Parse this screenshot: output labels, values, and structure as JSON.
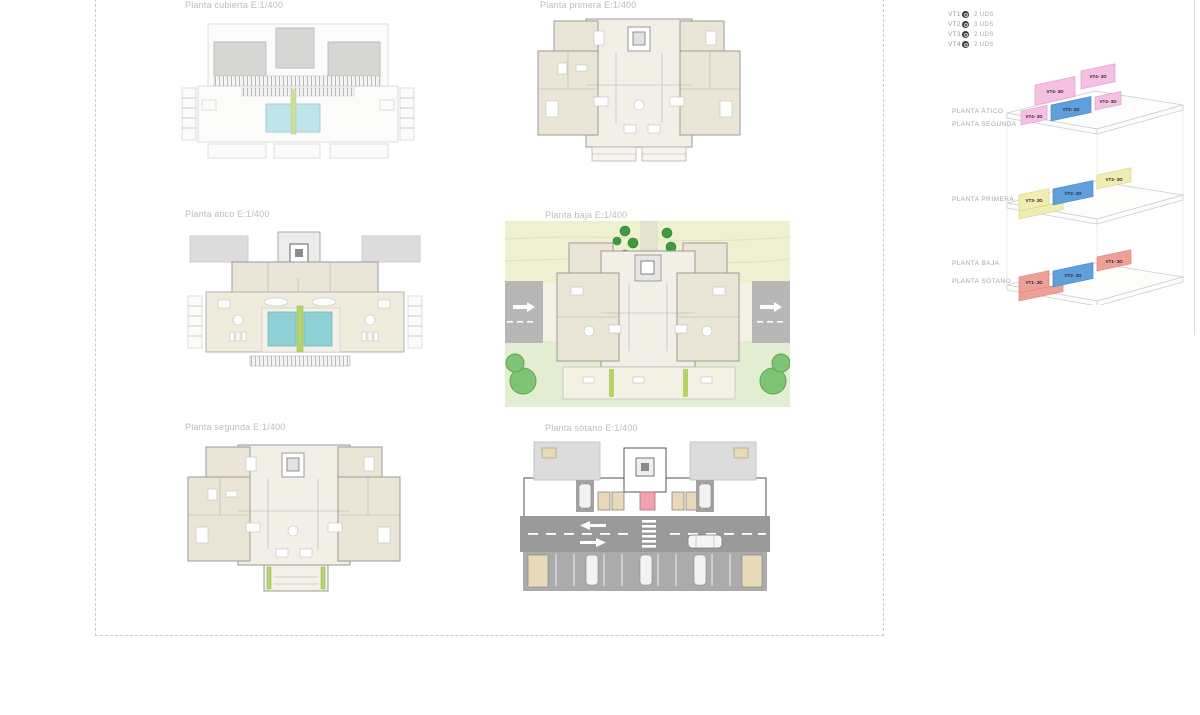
{
  "page": {
    "background": "#ffffff"
  },
  "colors": {
    "title_text": "#bcbcbc",
    "legend_text": "#9a9a9a",
    "floor_label_text": "#a6a6a6",
    "vt4_pink": "#f5c0e2",
    "vt2_blue": "#5f9fdc",
    "vt3_yellow": "#f1edb2",
    "vt1_salmon": "#efa096",
    "pool_teal": "#8fd0d4",
    "tree_green": "#3f9b3f",
    "hedge_green": "#b6d36b",
    "grass_green": "#e3edd2",
    "band_yellow_green": "#eef0d0",
    "road_gray": "#9a9a9a",
    "room_beige": "#eae5d6",
    "roof_gray": "#d6d6d4",
    "elevator_pink": "#efa3ac"
  },
  "plans": [
    {
      "id": "cubierta",
      "title": "Planta cubierta E:1/400"
    },
    {
      "id": "primera",
      "title": "Planta primera E:1/400"
    },
    {
      "id": "atico",
      "title": "Planta ático E:1/400"
    },
    {
      "id": "baja",
      "title": "Planta baja E:1/400"
    },
    {
      "id": "segunda",
      "title": "Planta segunda E:1/400"
    },
    {
      "id": "sotano",
      "title": "Planta sótano E:1/400"
    }
  ],
  "legend": {
    "items": [
      {
        "code": "VT1",
        "count": "2 UDS"
      },
      {
        "code": "VT2",
        "count": "3 UDS"
      },
      {
        "code": "VT3",
        "count": "2 UDS"
      },
      {
        "code": "VT4",
        "count": "2 UDS"
      }
    ]
  },
  "axon": {
    "floor_labels": [
      "PLANTA ÁTICO",
      "PLANTA SEGUNDA",
      "PLANTA PRIMERA",
      "PLANTA BAJA",
      "PLANTA SÓTANO"
    ],
    "blocks": {
      "atico_roof_left": "VT4- 3D",
      "atico_roof_right": "VT4- 3D",
      "segunda_left": "VT4- 3D",
      "segunda_center": "VT2- 2D",
      "segunda_right": "VT4- 3D",
      "primera_left": "VT3- 3D",
      "primera_center": "VT2- 2D",
      "primera_right": "VT3- 3D",
      "baja_left": "VT1- 3D",
      "baja_center": "VT2- 2D",
      "baja_right": "VT1- 3D"
    }
  }
}
